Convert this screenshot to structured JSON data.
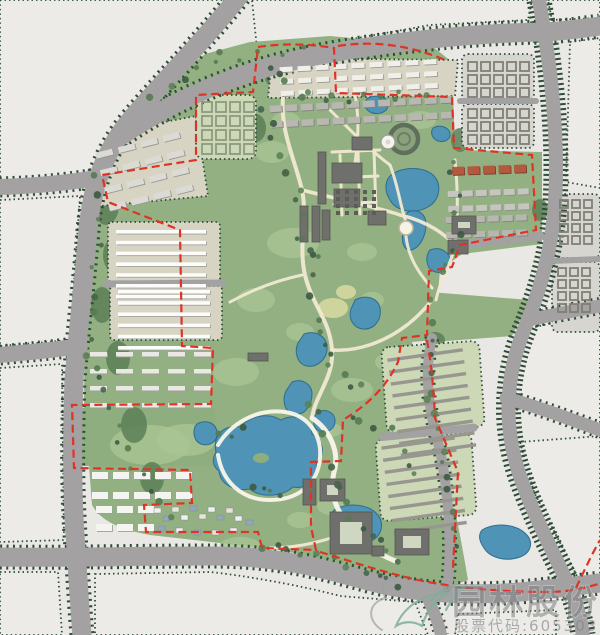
{
  "watermark": {
    "company": "园林股份",
    "stock_label": "股票代码:605303",
    "registered_mark": "®"
  },
  "map": {
    "kind": "landscape-master-plan",
    "features": {
      "boundary": "project-red-dashed-boundary",
      "park": "central-park-greenland",
      "water": "lakes-and-ponds",
      "roads": "tree-lined-city-roads",
      "blocks": "urban-blocks-and-housing"
    }
  },
  "colors": {
    "bg": "#e9e8e4",
    "road": "#a3a1a2",
    "roadEdge": "#2f4d39",
    "park": "#93b083",
    "parkLight": "#aac493",
    "meadowYellow": "#d6d89e",
    "water": "#4f93b6",
    "waterEdge": "#2e6d8e",
    "blockBeige": "#d8d4c4",
    "blockGreen": "#ccd8b6",
    "blockGray": "#d6d5d0",
    "blockWhite": "#ecebe7",
    "bldgWhite": "#f2f1ec",
    "bldgGray": "#8f8f8b",
    "bldgDark": "#6f6f6b",
    "terracotta": "#b2593f",
    "boundary": "#de3426",
    "pathCream": "#f1e9d2",
    "wmGray": "#808082",
    "logoGreen": "#7fae9b"
  }
}
